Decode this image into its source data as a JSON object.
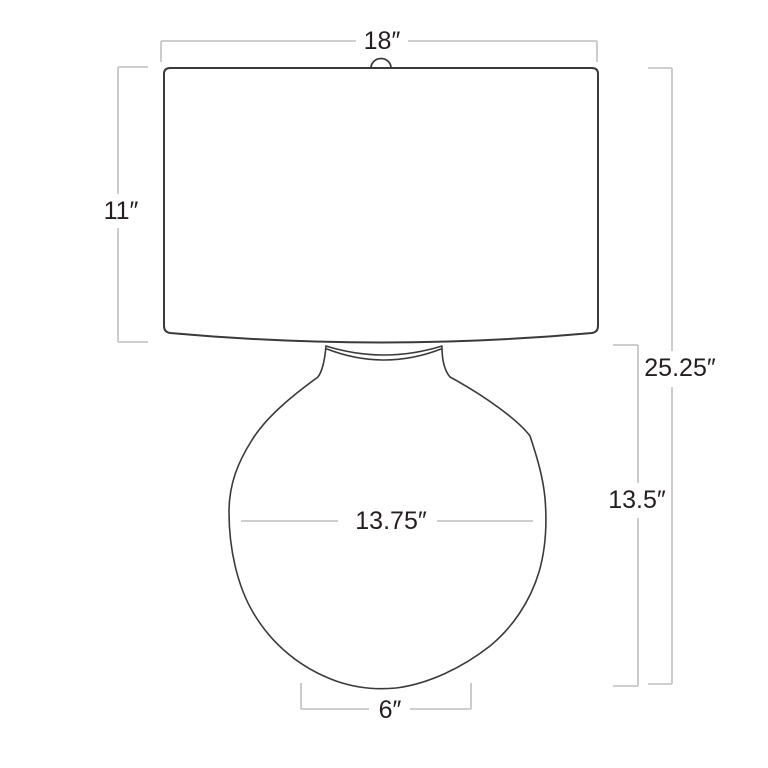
{
  "colors": {
    "outline": "#3a3a3a",
    "dimension": "#c7c7c7",
    "label": "#231f20",
    "background": "#ffffff"
  },
  "diagram": {
    "labels": {
      "shade_width": "18″",
      "shade_height": "11″",
      "overall_height": "25.25″",
      "body_height": "13.5″",
      "body_width": "13.75″",
      "base_width": "6″"
    }
  }
}
